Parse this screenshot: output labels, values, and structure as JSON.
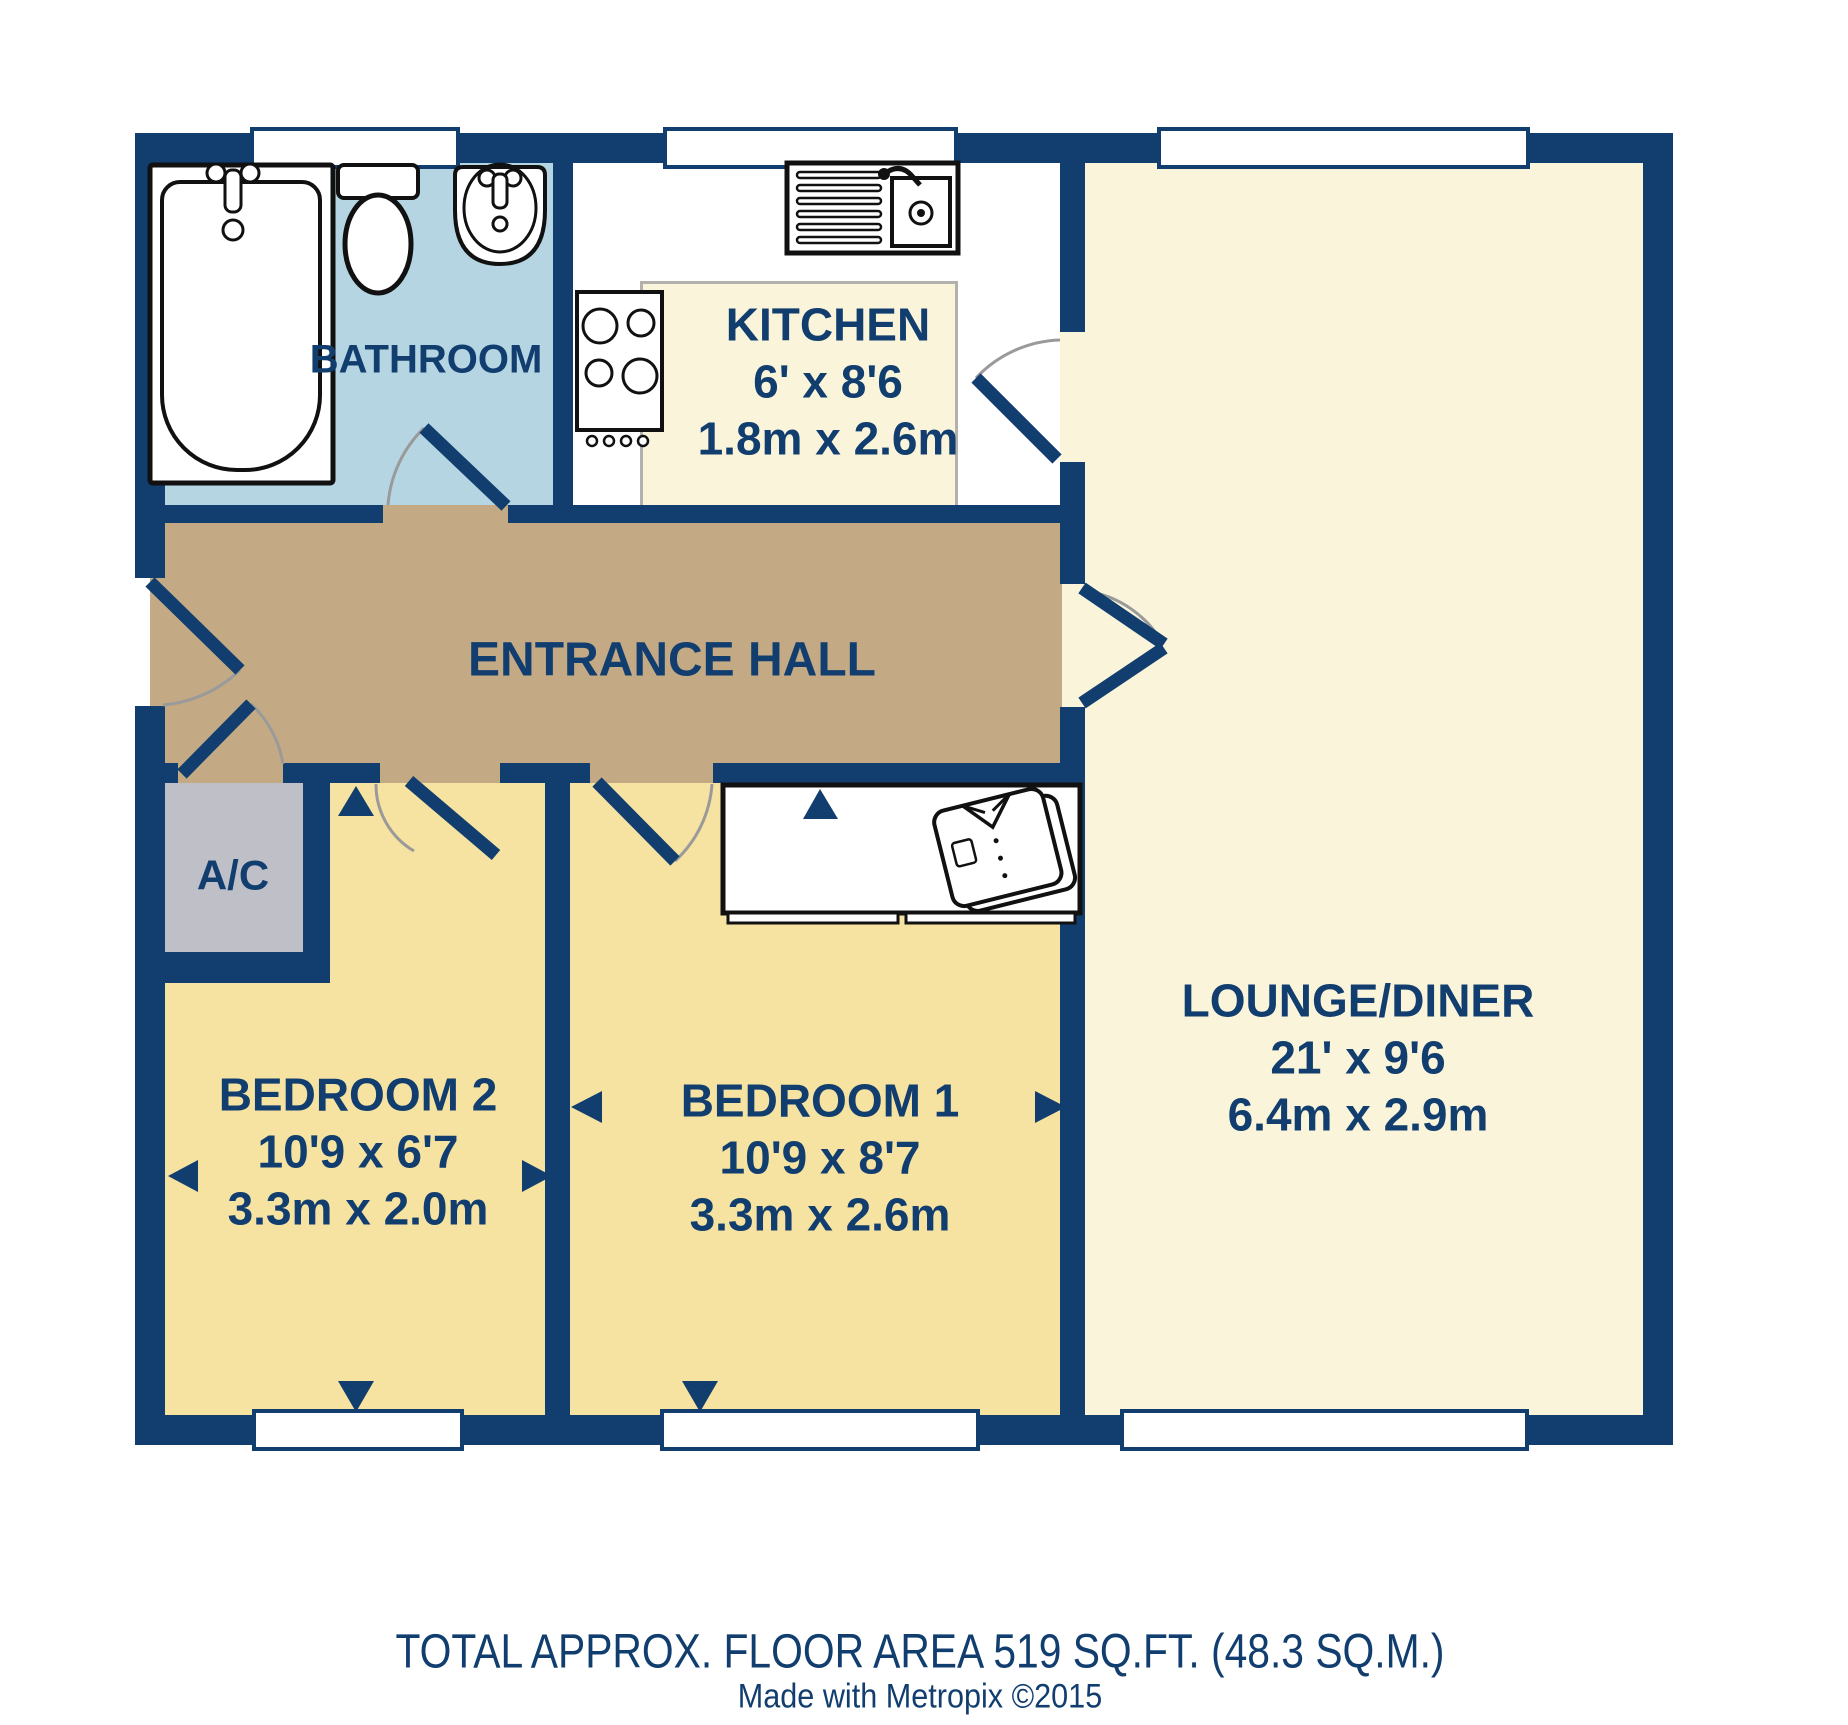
{
  "title": "Floor plan",
  "rooms": {
    "bathroom": {
      "name": "BATHROOM"
    },
    "kitchen": {
      "name": "KITCHEN",
      "dim_ft": "6' x 8'6",
      "dim_m": "1.8m x 2.6m"
    },
    "hall": {
      "name": "ENTRANCE HALL"
    },
    "ac": {
      "name": "A/C"
    },
    "bedroom2": {
      "name": "BEDROOM 2",
      "dim_ft": "10'9 x 6'7",
      "dim_m": "3.3m x 2.0m"
    },
    "bedroom1": {
      "name": "BEDROOM 1",
      "dim_ft": "10'9 x 8'7",
      "dim_m": "3.3m x 2.6m"
    },
    "lounge": {
      "name": "LOUNGE/DINER",
      "dim_ft": "21' x 9'6",
      "dim_m": "6.4m x 2.9m"
    }
  },
  "footer": {
    "area": "TOTAL APPROX. FLOOR AREA 519 SQ.FT. (48.3 SQ.M.)",
    "credit": "Made with Metropix ©2015"
  },
  "fixtures": [
    "bath",
    "toilet",
    "basin",
    "kitchen-sink",
    "hob",
    "wardrobe",
    "folded-shirt"
  ],
  "colors": {
    "wall_navy": "#113e6f",
    "hall_floor": "#c3aa85",
    "bedroom_floor": "#f6e3a1",
    "lounge_floor": "#faf4da",
    "bathroom_floor": "#b5d5e2",
    "closet_floor": "#bfbfc7",
    "window_white": "#ffffff",
    "door_arc_gray": "#9a9a9a",
    "counter_gray": "#b3b1ad"
  }
}
